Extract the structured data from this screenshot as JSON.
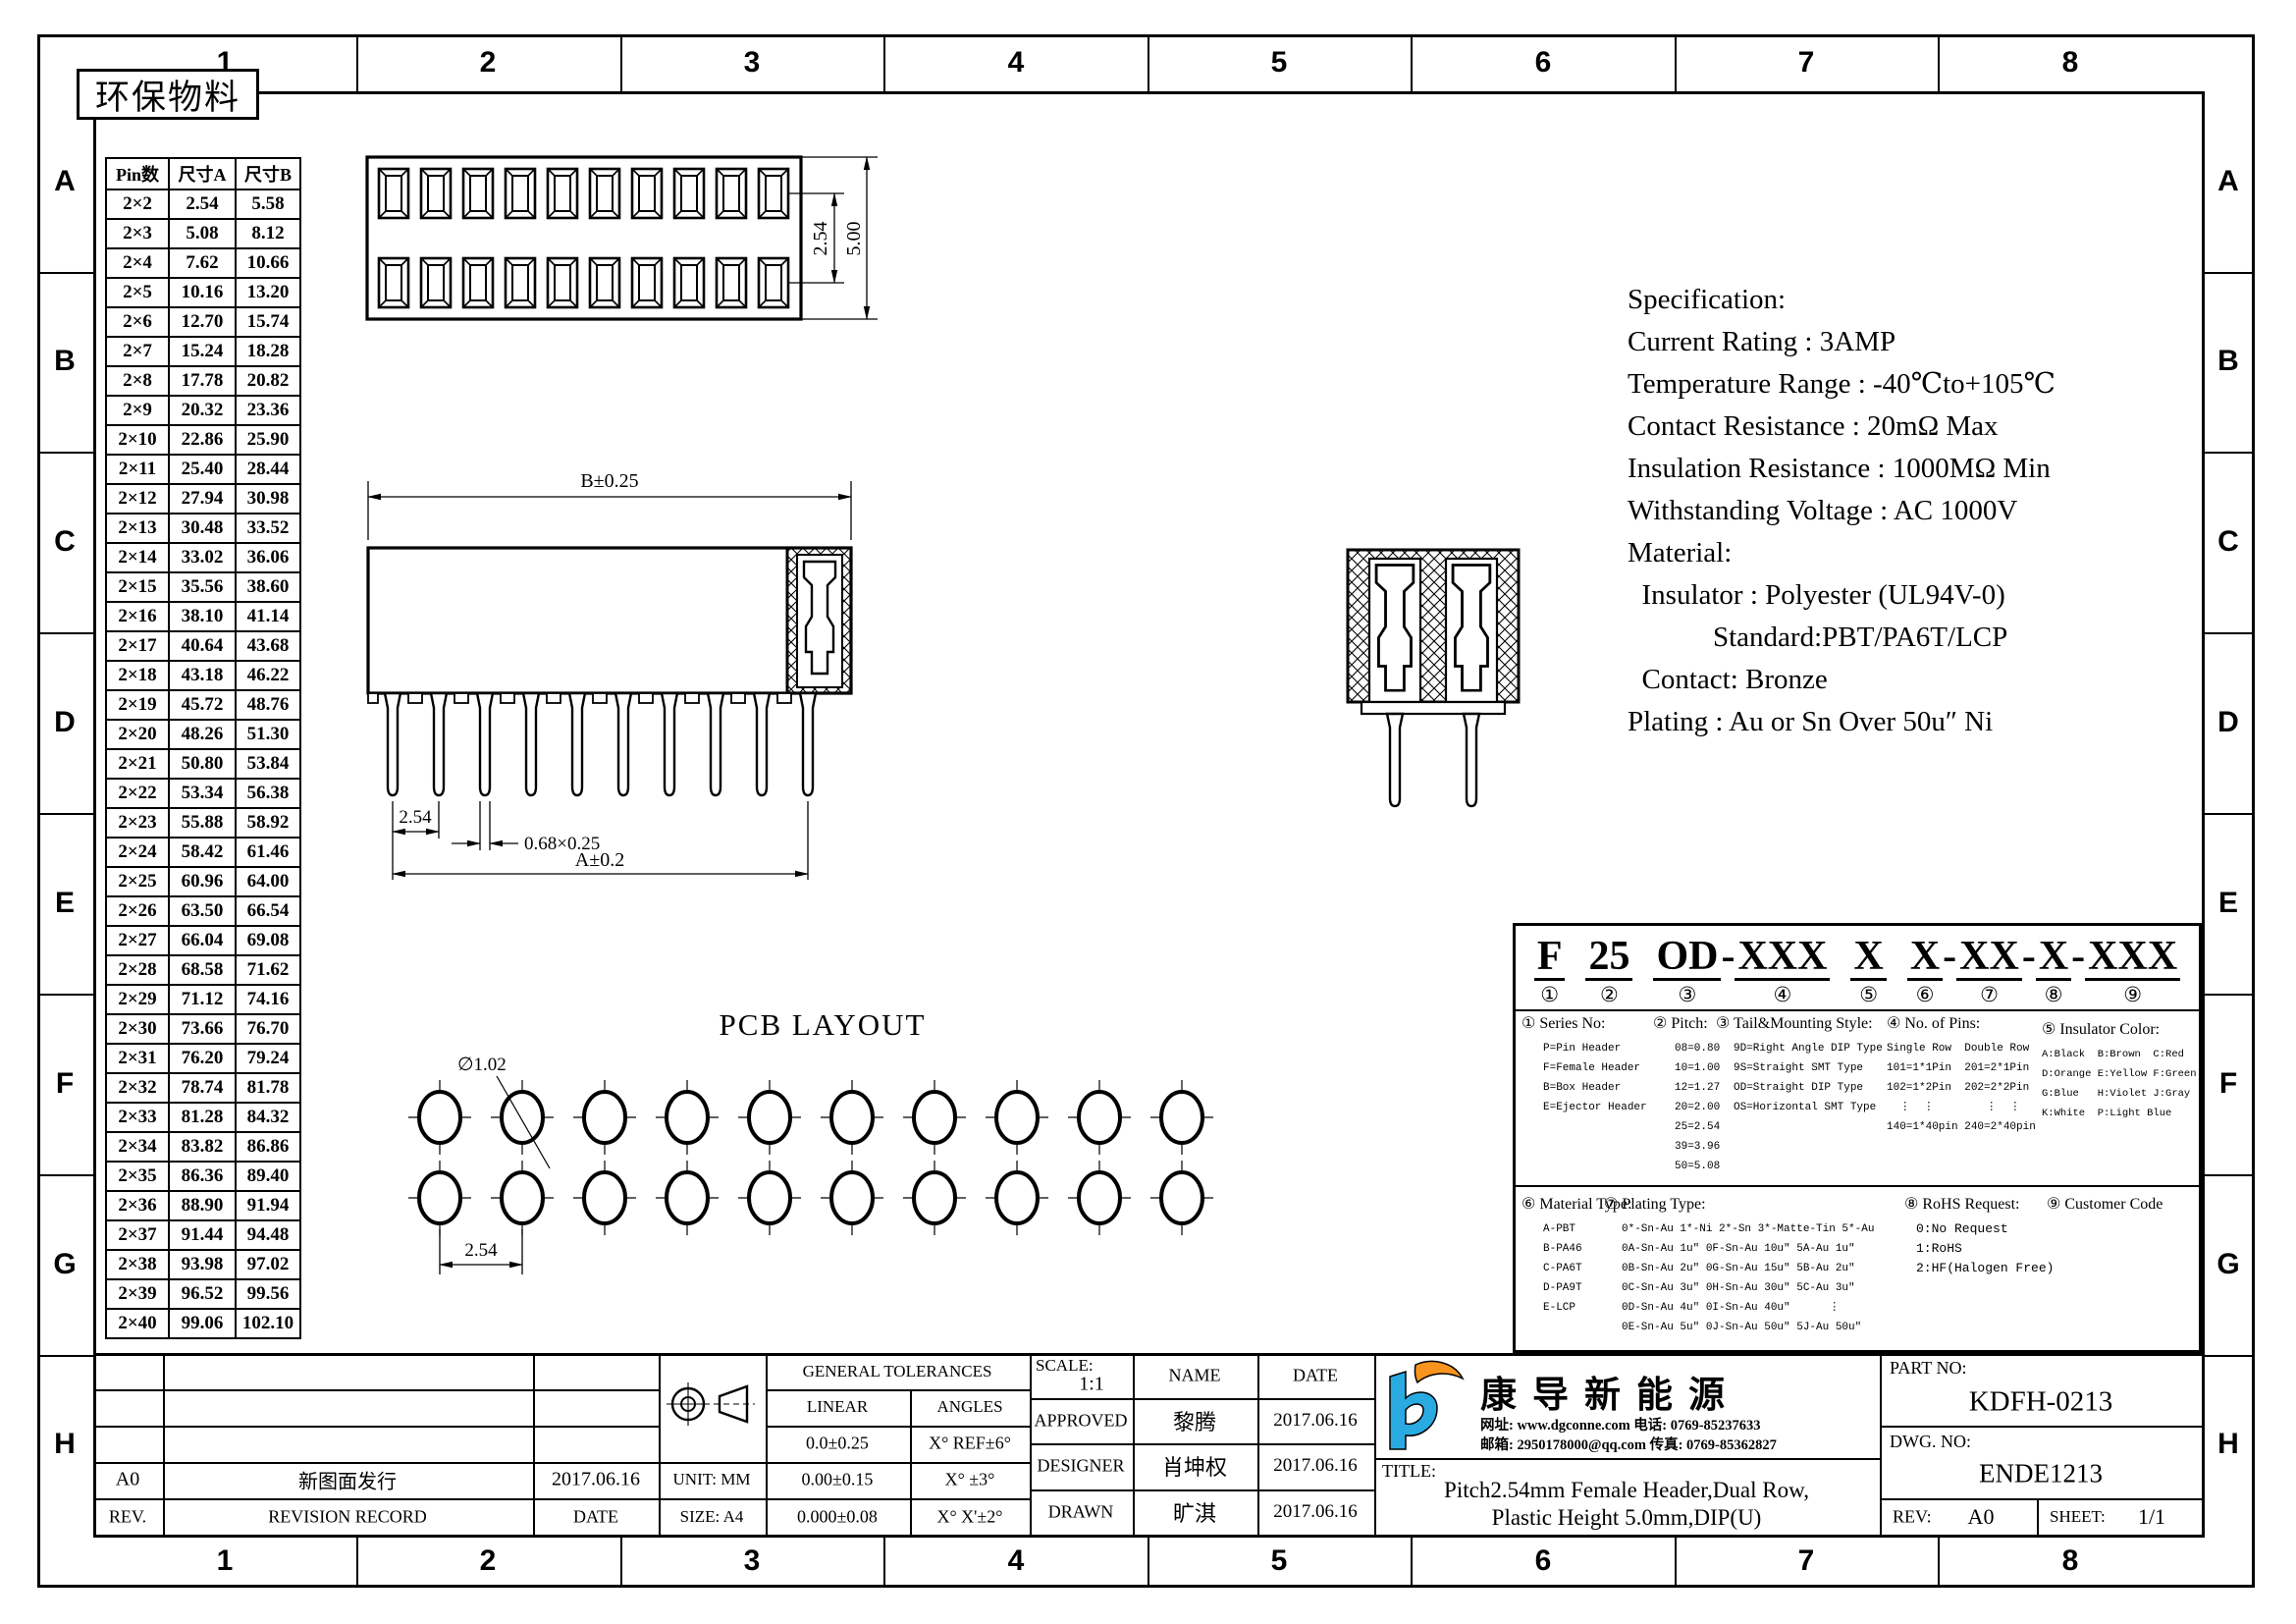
{
  "frame": {
    "grid_cols": [
      "1",
      "2",
      "3",
      "4",
      "5",
      "6",
      "7",
      "8"
    ],
    "grid_rows": [
      "A",
      "B",
      "C",
      "D",
      "E",
      "F",
      "G",
      "H"
    ],
    "eco_label": "环保物料"
  },
  "pin_table": {
    "headers": [
      "Pin数",
      "尺寸A",
      "尺寸B"
    ],
    "rows": [
      [
        "2×2",
        "2.54",
        "5.58"
      ],
      [
        "2×3",
        "5.08",
        "8.12"
      ],
      [
        "2×4",
        "7.62",
        "10.66"
      ],
      [
        "2×5",
        "10.16",
        "13.20"
      ],
      [
        "2×6",
        "12.70",
        "15.74"
      ],
      [
        "2×7",
        "15.24",
        "18.28"
      ],
      [
        "2×8",
        "17.78",
        "20.82"
      ],
      [
        "2×9",
        "20.32",
        "23.36"
      ],
      [
        "2×10",
        "22.86",
        "25.90"
      ],
      [
        "2×11",
        "25.40",
        "28.44"
      ],
      [
        "2×12",
        "27.94",
        "30.98"
      ],
      [
        "2×13",
        "30.48",
        "33.52"
      ],
      [
        "2×14",
        "33.02",
        "36.06"
      ],
      [
        "2×15",
        "35.56",
        "38.60"
      ],
      [
        "2×16",
        "38.10",
        "41.14"
      ],
      [
        "2×17",
        "40.64",
        "43.68"
      ],
      [
        "2×18",
        "43.18",
        "46.22"
      ],
      [
        "2×19",
        "45.72",
        "48.76"
      ],
      [
        "2×20",
        "48.26",
        "51.30"
      ],
      [
        "2×21",
        "50.80",
        "53.84"
      ],
      [
        "2×22",
        "53.34",
        "56.38"
      ],
      [
        "2×23",
        "55.88",
        "58.92"
      ],
      [
        "2×24",
        "58.42",
        "61.46"
      ],
      [
        "2×25",
        "60.96",
        "64.00"
      ],
      [
        "2×26",
        "63.50",
        "66.54"
      ],
      [
        "2×27",
        "66.04",
        "69.08"
      ],
      [
        "2×28",
        "68.58",
        "71.62"
      ],
      [
        "2×29",
        "71.12",
        "74.16"
      ],
      [
        "2×30",
        "73.66",
        "76.70"
      ],
      [
        "2×31",
        "76.20",
        "79.24"
      ],
      [
        "2×32",
        "78.74",
        "81.78"
      ],
      [
        "2×33",
        "81.28",
        "84.32"
      ],
      [
        "2×34",
        "83.82",
        "86.86"
      ],
      [
        "2×35",
        "86.36",
        "89.40"
      ],
      [
        "2×36",
        "88.90",
        "91.94"
      ],
      [
        "2×37",
        "91.44",
        "94.48"
      ],
      [
        "2×38",
        "93.98",
        "97.02"
      ],
      [
        "2×39",
        "96.52",
        "99.56"
      ],
      [
        "2×40",
        "99.06",
        "102.10"
      ]
    ]
  },
  "spec": {
    "lines": [
      "Specification:",
      "Current Rating : 3AMP",
      "Temperature Range : -40℃to+105℃",
      "Contact Resistance : 20mΩ Max",
      "Insulation Resistance : 1000MΩ Min",
      "Withstanding Voltage : AC 1000V",
      "Material:",
      "  Insulator : Polyester (UL94V-0)",
      "            Standard:PBT/PA6T/LCP",
      "  Contact: Bronze",
      "Plating : Au or Sn Over 50u″ Ni"
    ]
  },
  "drawings": {
    "pcb_title": "PCB LAYOUT",
    "top_view": {
      "row_pitch": "2.54",
      "total_height": "5.00"
    },
    "side_view": {
      "width_dim": "B±0.25",
      "span_dim": "A±0.2",
      "pin_pitch": "2.54",
      "pin_size": "0.68×0.25"
    },
    "pcb": {
      "hole_dia": "∅1.02",
      "pitch": "2.54"
    }
  },
  "part_code": {
    "segments": [
      {
        "t": "F",
        "n": "①",
        "sep": " "
      },
      {
        "t": "25",
        "n": "②",
        "sep": " "
      },
      {
        "t": "OD",
        "n": "③",
        "sep": "-"
      },
      {
        "t": "XXX",
        "n": "④",
        "sep": " "
      },
      {
        "t": "X",
        "n": "⑤",
        "sep": " "
      },
      {
        "t": "X",
        "n": "⑥",
        "sep": "-"
      },
      {
        "t": "XX",
        "n": "⑦",
        "sep": "-"
      },
      {
        "t": "X",
        "n": "⑧",
        "sep": "-"
      },
      {
        "t": "XXX",
        "n": "⑨",
        "sep": ""
      }
    ],
    "series": {
      "head": "① Series No:",
      "lines": [
        "P=Pin Header",
        "F=Female Header",
        "B=Box Header",
        "E=Ejector Header"
      ]
    },
    "pitch": {
      "head": "② Pitch:",
      "lines": [
        "08=0.80",
        "10=1.00",
        "12=1.27",
        "20=2.00",
        "25=2.54",
        "39=3.96",
        "50=5.08"
      ]
    },
    "tail": {
      "head": "③ Tail&Mounting Style:",
      "lines": [
        "9D=Right Angle DIP Type",
        "9S=Straight SMT Type",
        "OD=Straight DIP Type",
        "OS=Horizontal SMT Type"
      ]
    },
    "pins": {
      "head": "④ No. of Pins:",
      "lines": [
        "Single Row  Double Row",
        "101=1*1Pin  201=2*1Pin",
        "102=1*2Pin  202=2*2Pin",
        "  ⋮  ⋮        ⋮  ⋮",
        "140=1*40pin 240=2*40pin"
      ]
    },
    "color": {
      "head": "⑤ Insulator Color:",
      "lines": [
        "A:Black  B:Brown  C:Red",
        "D:Orange E:Yellow F:Green",
        "G:Blue   H:Violet J:Gray",
        "K:White  P:Light Blue"
      ]
    },
    "material": {
      "head": "⑥ Material Type:",
      "lines": [
        "A-PBT",
        "B-PA46",
        "C-PA6T",
        "D-PA9T",
        "E-LCP"
      ]
    },
    "plating": {
      "head": "⑦ Plating Type:",
      "lines": [
        "0*-Sn-Au 1*-Ni 2*-Sn 3*-Matte-Tin 5*-Au",
        "0A-Sn-Au 1u″ 0F-Sn-Au 10u″ 5A-Au 1u″",
        "0B-Sn-Au 2u″ 0G-Sn-Au 15u″ 5B-Au 2u″",
        "0C-Sn-Au 3u″ 0H-Sn-Au 30u″ 5C-Au 3u″",
        "0D-Sn-Au 4u″ 0I-Sn-Au 40u″      ⋮",
        "0E-Sn-Au 5u″ 0J-Sn-Au 50u″ 5J-Au 50u″"
      ]
    },
    "rohs": {
      "head": "⑧ RoHS Request:",
      "lines": [
        "0:No Request",
        "1:RoHS",
        "2:HF(Halogen Free)"
      ]
    },
    "customer": {
      "head": "⑨ Customer Code",
      "lines": []
    }
  },
  "title_block": {
    "rev_col_header": "REV.",
    "record_header": "REVISION RECORD",
    "date_header": "DATE",
    "revision_row": {
      "rev": "A0",
      "record": "新图面发行",
      "date": "2017.06.16"
    },
    "unit": "UNIT: MM",
    "size": "SIZE: A4",
    "tolerances": {
      "title": "GENERAL TOLERANCES",
      "linear": "LINEAR",
      "angles": "ANGLES",
      "rows": [
        [
          "0.0±0.25",
          "X° REF±6°"
        ],
        [
          "0.00±0.15",
          "X° ±3°"
        ],
        [
          "0.000±0.08",
          "X° X'±2°"
        ]
      ]
    },
    "scale_label": "SCALE:",
    "scale_value": "1:1",
    "name_header": "NAME",
    "date_header2": "DATE",
    "approved": {
      "label": "APPROVED",
      "name": "黎腾",
      "date": "2017.06.16"
    },
    "designer": {
      "label": "DESIGNER",
      "name": "肖坤权",
      "date": "2017.06.16"
    },
    "drawn": {
      "label": "DRAWN",
      "name": "旷淇",
      "date": "2017.06.16"
    },
    "company": {
      "name": "康导新能源",
      "contact1": "网址: www.dgconne.com  电话: 0769-85237633",
      "contact2": "邮箱: 2950178000@qq.com 传真: 0769-85362827"
    },
    "title_label": "TITLE:",
    "title_line1": "Pitch2.54mm Female Header,Dual Row,",
    "title_line2": "Plastic Height 5.0mm,DIP(U)",
    "part_no_label": "PART NO:",
    "part_no": "KDFH-0213",
    "dwg_no_label": "DWG. NO:",
    "dwg_no": "ENDE1213",
    "rev_label": "REV:",
    "rev_value": "A0",
    "sheet_label": "SHEET:",
    "sheet_value": "1/1"
  }
}
